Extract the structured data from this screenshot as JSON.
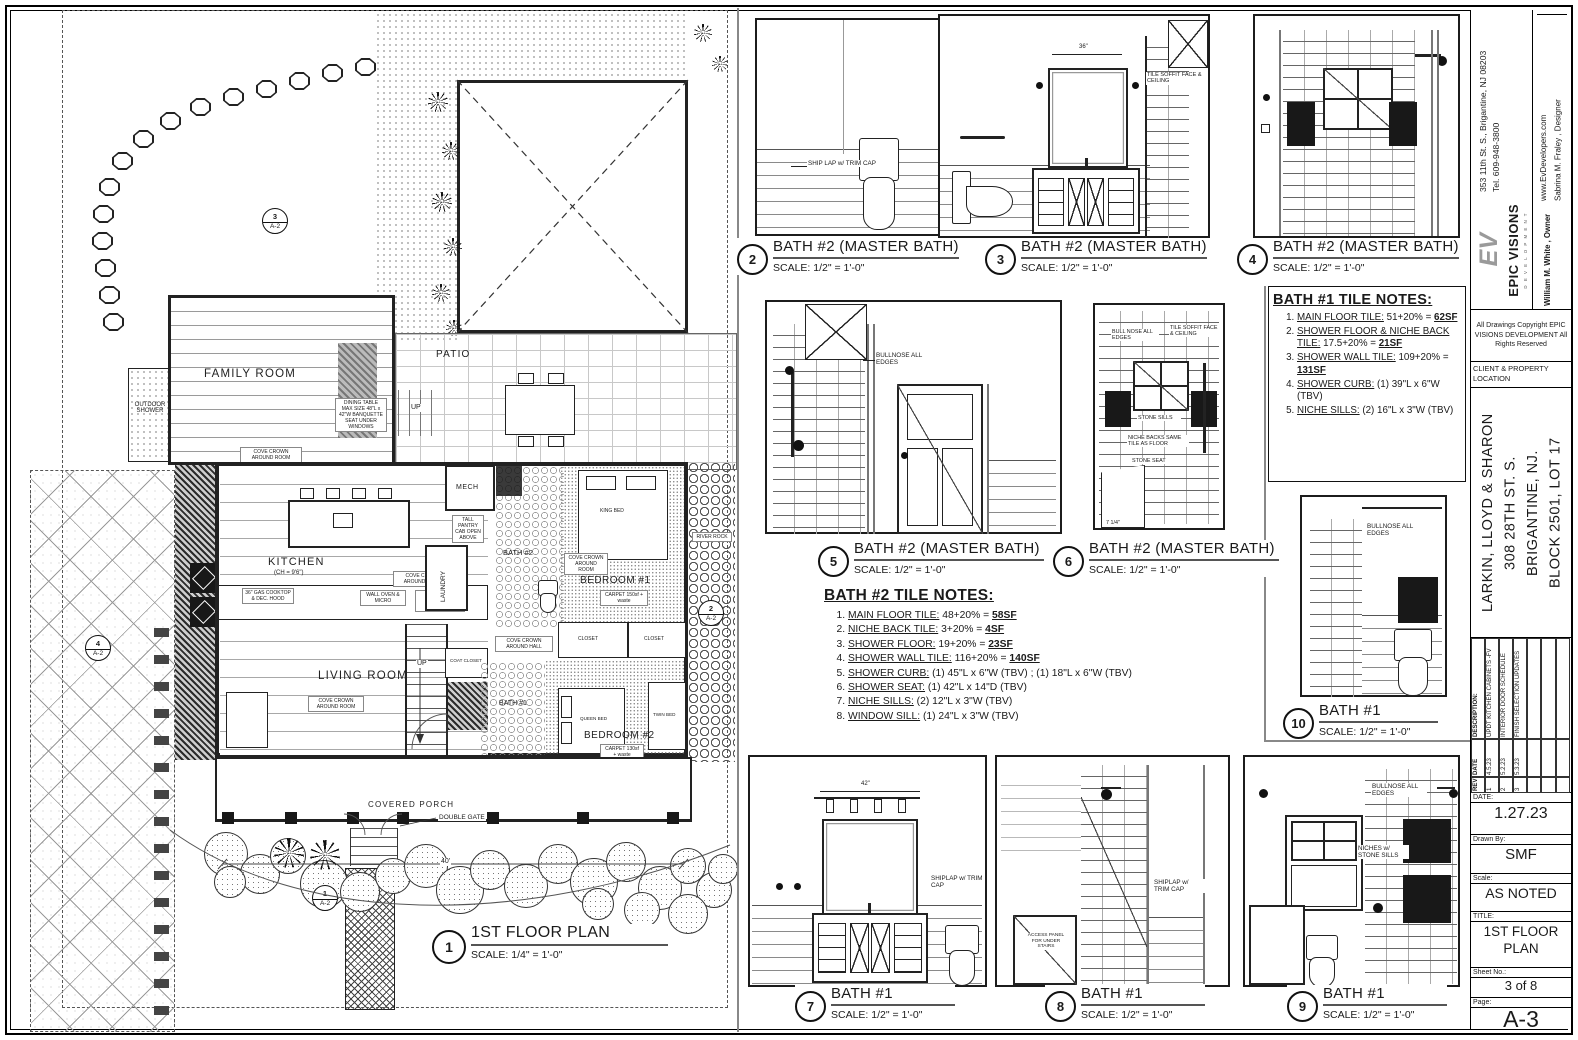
{
  "titleblock": {
    "address": "353 11th St. S., Brigantine, NJ 08203",
    "phone": "Tel. 609-948-3800",
    "website": "www.EvDevelopers.com",
    "designer": "Sabrina M. Fraley , Designer",
    "logo": "EV",
    "company": "EPIC VISIONS",
    "company_sub": "D E V E L O P M E N T",
    "owner": "William M. White , Owner",
    "copyright": "All Drawings Copyright EPIC VISIONS DEVELOPMENT All Rights Reserved",
    "client_header": "CLIENT & PROPERTY LOCATION",
    "client_line1": "LARKIN, LLOYD & SHARON",
    "client_line2": "308 28TH ST. S.",
    "client_line3": "BRIGANTINE, NJ.",
    "client_line4": "BLOCK 2501, LOT 17",
    "rev_table": {
      "headers": {
        "rev": "REV",
        "date": "DATE",
        "desc": "DESCRIPTION:"
      },
      "rows": [
        {
          "rev": "1",
          "date": "4.5.23",
          "desc": "UPDT KITCHEN CABINETS -FV"
        },
        {
          "rev": "2",
          "date": "5.2.23",
          "desc": "INTERIOR DOOR SCHEDULE"
        },
        {
          "rev": "3",
          "date": "5.3.23",
          "desc": "FINISH SELECTION UPDATES"
        }
      ]
    },
    "date_label": "DATE:",
    "date": "1.27.23",
    "drawn_label": "Drawn By:",
    "drawn": "SMF",
    "scale_label": "Scale:",
    "scale": "AS NOTED",
    "title_label": "TITLE:",
    "title": "1ST FLOOR PLAN",
    "sheet_label": "Sheet No.:",
    "sheet": "3 of 8",
    "page_label": "Page:",
    "page": "A-3"
  },
  "floor_plan": {
    "number": "1",
    "title": "1ST FLOOR PLAN",
    "scale": "SCALE: 1/4\" = 1'-0\"",
    "labels": {
      "family_room": "FAMILY ROOM",
      "patio": "PATIO",
      "kitchen": "KITCHEN",
      "kitchen_ch": "(CH = 9'6\")",
      "living_room": "LIVING ROOM",
      "bedroom1": "BEDROOM #1",
      "bedroom2": "BEDROOM #2",
      "bath1": "BATH #1",
      "bath2": "BATH #2",
      "mech": "MECH",
      "laundry": "LAUNDRY",
      "outdoor_shower": "OUTDOOR SHOWER",
      "covered_porch": "COVERED PORCH",
      "double_gate": "DOUBLE GATE",
      "river_rock": "RIVER ROCK",
      "up": "UP",
      "king_bed": "KING BED",
      "queen_bed": "QUEEN BED",
      "twin_bed": "TWIN BED",
      "closet": "CLOSET",
      "coat_closet": "COAT CLOSET",
      "cove_room": "COVE CROWN AROUND ROOM",
      "cove_hall": "COVE CROWN AROUND HALL",
      "dining_note": "DINING TABLE MAX SIZE 48\"L x 42\"W BANQUETTE SEAT UNDER WINDOWS",
      "cooktop": "36\" GAS COOKTOP & DEC. HOOD",
      "wall_oven": "WALL OVEN & MICRO",
      "refrig": "REFRIG. w/CABINET ABOVE",
      "pantry": "TALL PANTRY CAB OPEN ABOVE",
      "carpet1": "CARPET 150sf + waste",
      "carpet2": "CARPET 130sf + waste",
      "dim40": "40'"
    },
    "markers": {
      "m1": "1",
      "m2": "2",
      "m3": "3",
      "m4": "4",
      "sheet_ref": "A-2"
    }
  },
  "elevations": [
    {
      "number": "2",
      "title": "BATH #2 (MASTER BATH)",
      "scale": "SCALE: 1/2\" = 1'-0\""
    },
    {
      "number": "3",
      "title": "BATH #2 (MASTER BATH)",
      "scale": "SCALE: 1/2\" = 1'-0\""
    },
    {
      "number": "4",
      "title": "BATH #2 (MASTER BATH)",
      "scale": "SCALE: 1/2\" = 1'-0\""
    },
    {
      "number": "5",
      "title": "BATH #2 (MASTER BATH)",
      "scale": "SCALE: 1/2\" = 1'-0\""
    },
    {
      "number": "6",
      "title": "BATH #2 (MASTER BATH)",
      "scale": "SCALE: 1/2\" = 1'-0\""
    },
    {
      "number": "10",
      "title": "BATH #1",
      "scale": "SCALE: 1/2\" = 1'-0\""
    },
    {
      "number": "7",
      "title": "BATH #1",
      "scale": "SCALE: 1/2\" = 1'-0\""
    },
    {
      "number": "8",
      "title": "BATH #1",
      "scale": "SCALE: 1/2\" = 1'-0\""
    },
    {
      "number": "9",
      "title": "BATH #1",
      "scale": "SCALE: 1/2\" = 1'-0\""
    }
  ],
  "elevation_annotations": {
    "shiplap_trim": "SHIP LAP w/ TRIM CAP",
    "shiplap_trim2": "SHIPLAP w/ TRIM CAP",
    "tile_soffit": "TILE SOFFIT FACE & CEILING",
    "bullnose": "BULLNOSE ALL EDGES",
    "bullnose2": "BULL NOSE ALL EDGES",
    "stone_sills": "STONE SILLS",
    "niche_backs": "NICHE BACKS SAME TILE AS FLOOR",
    "stone_seat": "STONE SEAT",
    "access_panel": "ACCESS PANEL FOR UNDER STAIRS",
    "niches_stone": "NICHES w/ STONE SILLS",
    "dim36": "36\"",
    "dim42": "42\"",
    "dim714": "7 1/4\""
  },
  "tile_notes": {
    "bath1": {
      "title": "BATH #1 TILE NOTES:",
      "items": [
        {
          "t": "MAIN FLOOR TILE:",
          "r": " 51+20% = ",
          "b": "62SF"
        },
        {
          "t": "SHOWER FLOOR & NICHE BACK TILE:",
          "r": " 17.5+20% = ",
          "b": "21SF"
        },
        {
          "t": "SHOWER WALL TILE:",
          "r": " 109+20% = ",
          "b": "131SF"
        },
        {
          "t": "SHOWER CURB:",
          "r": " (1) 39\"L x 6\"W (TBV)",
          "b": ""
        },
        {
          "t": "NICHE SILLS:",
          "r": " (2) 16\"L x 3\"W (TBV)",
          "b": ""
        }
      ]
    },
    "bath2": {
      "title": "BATH #2 TILE NOTES:",
      "items": [
        {
          "t": "MAIN FLOOR TILE:",
          "r": " 48+20% = ",
          "b": "58SF"
        },
        {
          "t": "NICHE BACK TILE:",
          "r": " 3+20% = ",
          "b": "4SF"
        },
        {
          "t": "SHOWER FLOOR:",
          "r": " 19+20% = ",
          "b": "23SF"
        },
        {
          "t": "SHOWER WALL TILE:",
          "r": "  116+20% = ",
          "b": "140SF"
        },
        {
          "t": "SHOWER CURB:",
          "r": " (1) 45\"L x 6\"W (TBV) ; (1) 18\"L x 6\"W (TBV)",
          "b": ""
        },
        {
          "t": "SHOWER SEAT:",
          "r": " (1) 42\"L x 14\"D (TBV)",
          "b": ""
        },
        {
          "t": "NICHE SILLS:",
          "r": "  (2) 12\"L x 3\"W (TBV)",
          "b": ""
        },
        {
          "t": "WINDOW SILL:",
          "r": "  (1) 24\"L x 3\"W (TBV)",
          "b": ""
        }
      ]
    }
  }
}
